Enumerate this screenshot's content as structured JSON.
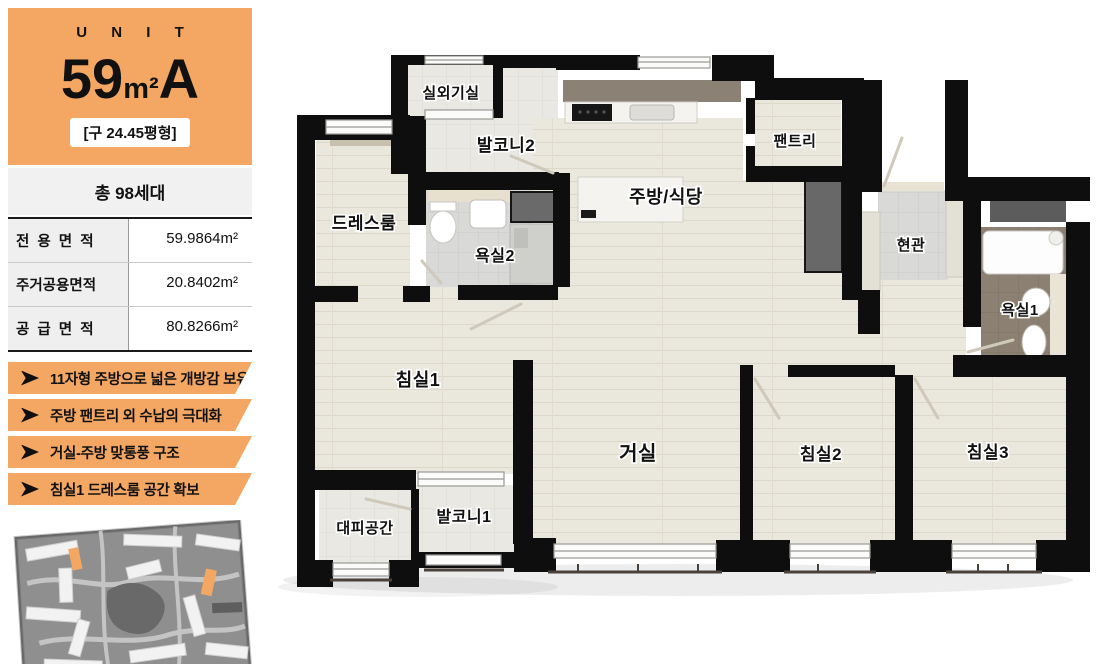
{
  "sidebar": {
    "unit_label": "U N I T",
    "size_number": "59",
    "size_unit": "m²",
    "type_letter": "A",
    "old_area": "[구 24.45평형]",
    "households": "총 98세대",
    "area_table": {
      "rows": [
        {
          "label": "전  용  면  적",
          "value": "59.9864m²"
        },
        {
          "label": "주거공용면적",
          "value": "20.8402m²"
        },
        {
          "label": "공  급  면  적",
          "value": "80.8266m²"
        }
      ]
    },
    "features": [
      "11자형 주방으로 넓은 개방감 보유",
      "주방 팬트리 외 수납의 극대화",
      "거실-주방 맞통풍 구조",
      "침실1 드레스룸 공간 확보"
    ]
  },
  "floorplan": {
    "rooms": [
      {
        "id": "outdoor-unit-room",
        "label": "실외기실",
        "x": 173,
        "y": 46,
        "fs": 15
      },
      {
        "id": "balcony-2",
        "label": "발코니2",
        "x": 228,
        "y": 99,
        "fs": 17
      },
      {
        "id": "dress-room",
        "label": "드레스룸",
        "x": 86,
        "y": 177,
        "fs": 17
      },
      {
        "id": "bathroom-2",
        "label": "욕실2",
        "x": 217,
        "y": 209,
        "fs": 16
      },
      {
        "id": "kitchen-dining",
        "label": "주방/식당",
        "x": 388,
        "y": 151,
        "fs": 18
      },
      {
        "id": "pantry",
        "label": "팬트리",
        "x": 517,
        "y": 94,
        "fs": 15
      },
      {
        "id": "entrance",
        "label": "현관",
        "x": 633,
        "y": 198,
        "fs": 15
      },
      {
        "id": "bathroom-1",
        "label": "욕실1",
        "x": 742,
        "y": 263,
        "fs": 15
      },
      {
        "id": "bedroom-1",
        "label": "침실1",
        "x": 140,
        "y": 334,
        "fs": 18
      },
      {
        "id": "living-room",
        "label": "거실",
        "x": 360,
        "y": 408,
        "fs": 20
      },
      {
        "id": "bedroom-2",
        "label": "침실2",
        "x": 543,
        "y": 408,
        "fs": 17
      },
      {
        "id": "bedroom-3",
        "label": "침실3",
        "x": 710,
        "y": 406,
        "fs": 17
      },
      {
        "id": "refuge-space",
        "label": "대피공간",
        "x": 87,
        "y": 481,
        "fs": 15
      },
      {
        "id": "balcony-1",
        "label": "발코니1",
        "x": 186,
        "y": 470,
        "fs": 16
      }
    ]
  },
  "colors": {
    "accent_orange": "#F4A763",
    "wall_black": "#0E0E0E",
    "wood_floor": "#EAE7DC",
    "tile_floor": "#E9E8E4",
    "bath_dark_tile": "#8B8071"
  }
}
